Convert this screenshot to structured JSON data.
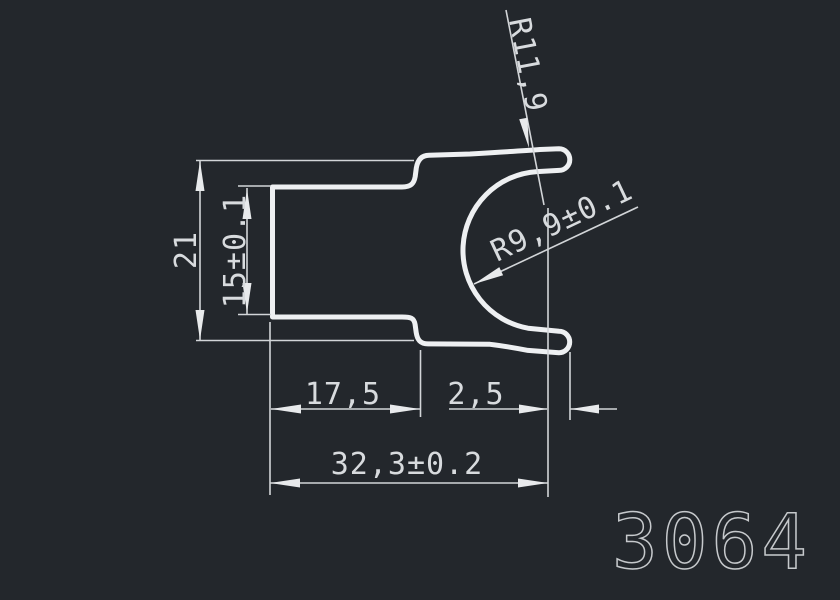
{
  "drawing": {
    "part_number": "3064",
    "background_color": "#23272c",
    "profile_line_color": "#eef0f2",
    "dimension_line_color": "#d2d5d8",
    "dimension_text_color": "#d8dbde",
    "part_number_color": "#c6c9cc",
    "dimensions": {
      "outer_height": "21",
      "inner_height": "15±0.1",
      "outer_radius": "R11,9",
      "inner_radius": "R9,9±0.1",
      "left_width": "17,5",
      "tip_thickness": "2,5",
      "total_width": "32,3±0.2"
    }
  }
}
